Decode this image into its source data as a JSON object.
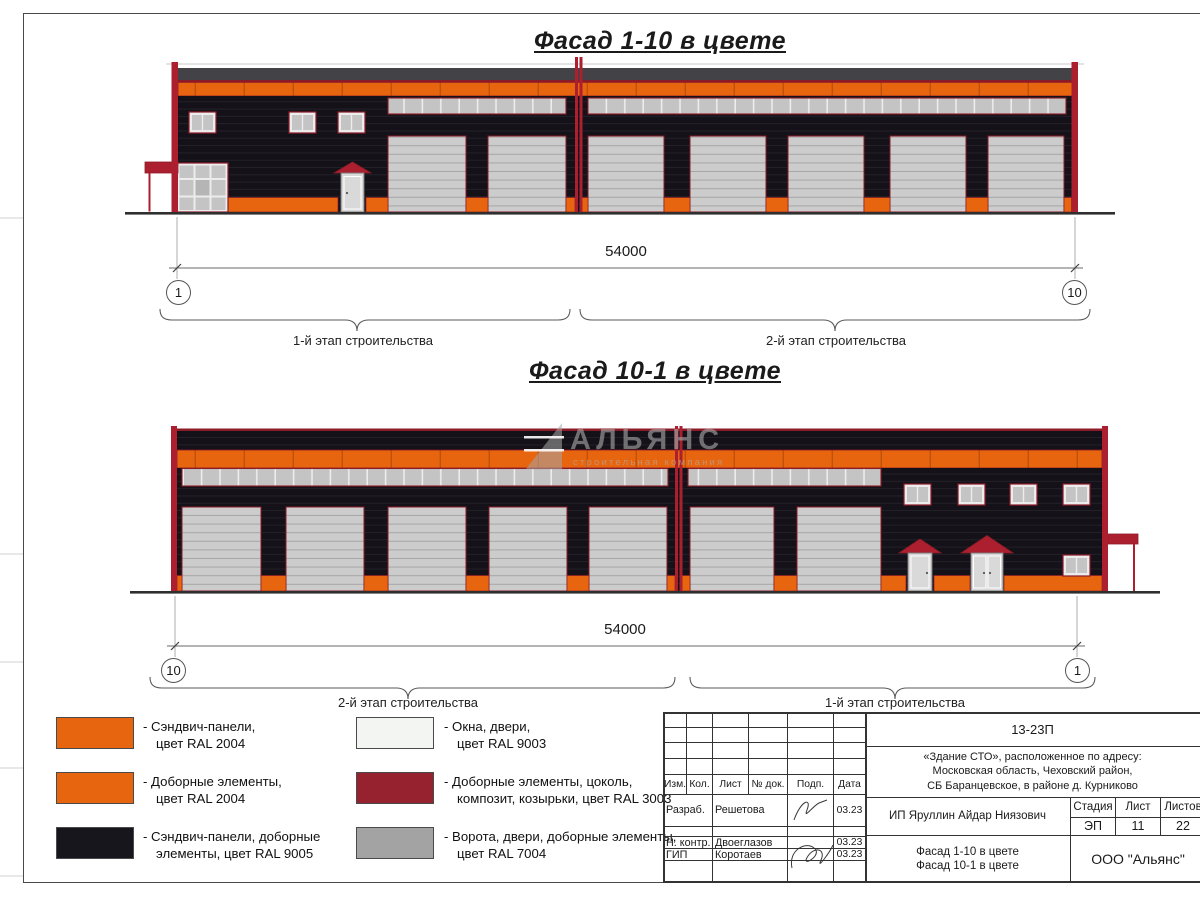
{
  "colors": {
    "orange": "#E7650E",
    "orange_seam": "#C05108",
    "black": "#141218",
    "black_seam": "#26242C",
    "red": "#AC1F2E",
    "red_line": "#8C1B28",
    "roof": "#434246",
    "gate": "#CCCCCC",
    "gate_seam": "#A6A6A6",
    "pane": "#C4C4C4",
    "pane_frame": "#ECECEC",
    "door": "#D9D9D9",
    "ground": "#2F2F2F",
    "frame": "#4A4A4A",
    "watermark": "#ACACAC"
  },
  "facades": {
    "f1": {
      "title": "Фасад 1-10 в цвете",
      "dim": "54000",
      "axis_left": "1",
      "axis_right": "10",
      "stage_left": "1-й этап строительства",
      "stage_right": "2-й этап строительства"
    },
    "f2": {
      "title": "Фасад 10-1 в цвете",
      "dim": "54000",
      "axis_left": "10",
      "axis_right": "1",
      "stage_left": "2-й этап строительства",
      "stage_right": "1-й этап строительства"
    }
  },
  "watermark": {
    "name": "АЛЬЯНС",
    "subtitle": "строительная компания"
  },
  "legend": [
    {
      "color": "#E7650E",
      "line1": "- Сэндвич-панели,",
      "line2": "цвет RAL 2004"
    },
    {
      "color": "#E7650E",
      "line1": "- Доборные элементы,",
      "line2": "цвет RAL 2004"
    },
    {
      "color": "#17161C",
      "line1": "- Сэндвич-панели, доборные",
      "line2": "элементы, цвет RAL 9005"
    },
    {
      "color": "#F2F5F2",
      "line1": "- Окна, двери,",
      "line2": "цвет RAL 9003"
    },
    {
      "color": "#96212F",
      "line1": "- Доборные элементы, цоколь,",
      "line2": "композит, козырьки, цвет RAL 3003"
    },
    {
      "color": "#A3A3A3",
      "line1": "- Ворота, двери, доборные элементы,",
      "line2": "цвет RAL 7004"
    }
  ],
  "title_block": {
    "doc_number": "13-23П",
    "object_line1": "«Здание СТО», расположенное по адресу:",
    "object_line2": "Московская область, Чеховский район,",
    "object_line3": "СБ Баранцевское, в районе д. Курниково",
    "col_izm": "Изм.",
    "col_kol": "Кол.",
    "col_list": "Лист",
    "col_doc": "№ док.",
    "col_podp": "Подп.",
    "col_data": "Дата",
    "row1_role": "Разраб.",
    "row1_name": "Решетова",
    "row1_date": "03.23",
    "row2_role": "Н. контр.",
    "row2_name": "Двоеглазов",
    "row2_date": "03.23",
    "row3_role": "ГИП",
    "row3_name": "Коротаев",
    "row3_date": "03.23",
    "client": "ИП Яруллин Айдар Ниязович",
    "stage_label": "Стадия",
    "list_label": "Лист",
    "listov_label": "Листов",
    "stage_value": "ЭП",
    "list_value": "11",
    "listov_value": "22",
    "drawing_title1": "Фасад 1-10 в цвете",
    "drawing_title2": "Фасад 10-1 в цвете",
    "company": "ООО \"Альянс\""
  }
}
